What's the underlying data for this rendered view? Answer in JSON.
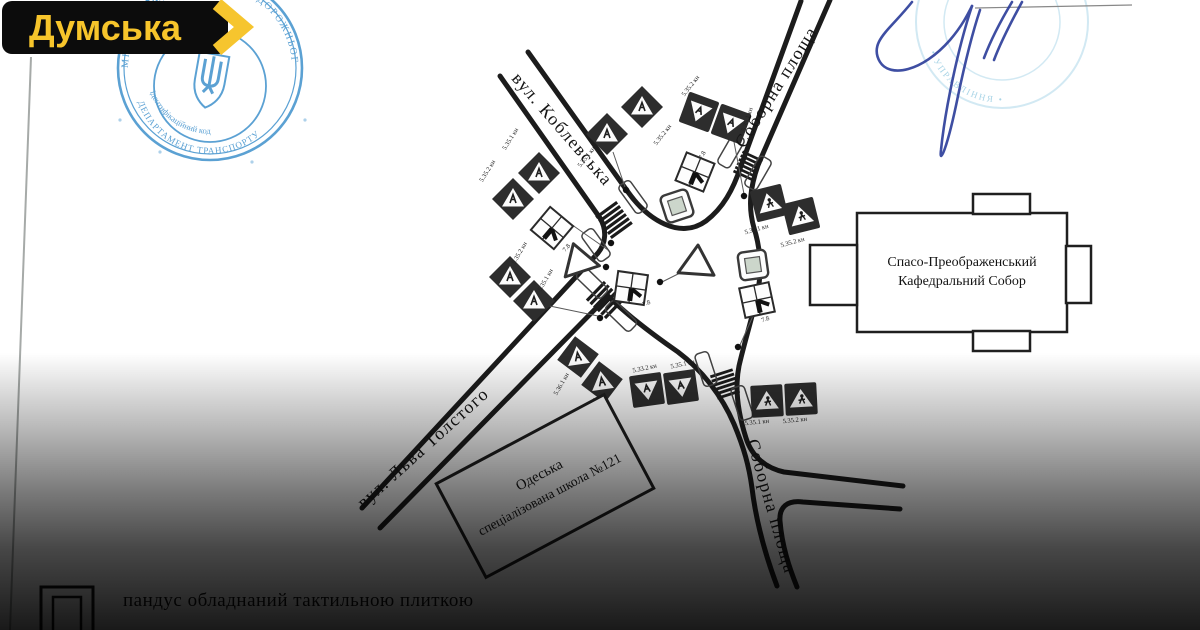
{
  "logo": {
    "text": "Думська",
    "bg_color": "#0c0c0c",
    "text_color": "#F7C52B"
  },
  "watermarks": {
    "left_stamp": {
      "ring_text": "МІСЬКА РАДА • ОРГАНІЗАЦІЇ ДОРОЖНЬОГО РУХУ • 25987115",
      "side_text": "ДЕПАРТАМЕНТ ТРАНСПОРТУ",
      "inner_text": "ідентифікаційний код",
      "color": "#4a97cf"
    },
    "right_stamp": {
      "arc_text": "• УПРАВЛІННЯ •",
      "color": "#a6d3e8"
    },
    "signature_color": "#2e3f9b"
  },
  "map": {
    "street_labels": {
      "koblevska": "вул. Коблевська",
      "soborna_top": "Соборна площа",
      "tolstogo": "вул. Льва Толстого",
      "soborna_bottom": "Соборна площа"
    },
    "buildings": {
      "cathedral": {
        "line1": "Спасо-Преображенський",
        "line2": "Кафедральний Собор"
      },
      "school": {
        "line1": "Одеська",
        "line2": "спеціалізована школа №121"
      }
    },
    "sign_labels": {
      "ped1": "5.35.1 кн",
      "ped2": "5.35.2 кн",
      "walk1": "5.36.1 кн",
      "walk2": "5.36.2 кн",
      "alt": "5.33.2 кн",
      "rm": "7.8"
    }
  },
  "caption": {
    "text": "пандус обладнаний тактильною плиткою"
  }
}
